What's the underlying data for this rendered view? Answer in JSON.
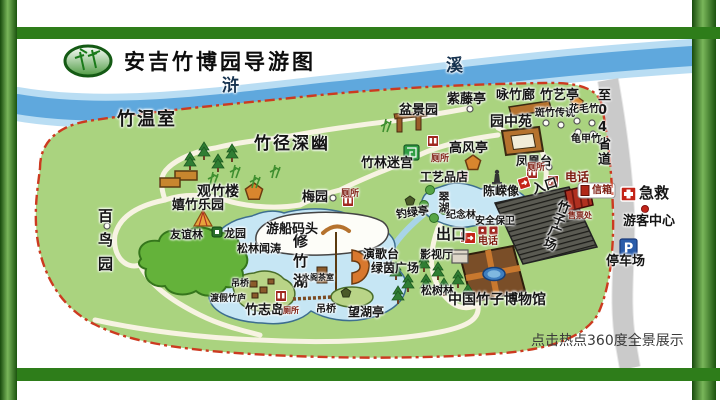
{
  "palette": {
    "frame_green": "#2e7d1a",
    "park_green": "#aad37f",
    "river_blue": "#5fa8dd",
    "lake_blue": "#c6e6f4",
    "boundary_red": "#cc3a20",
    "road_gray": "#d2d2d2",
    "facility_red": "#a02820",
    "parking_blue": "#2a5caa"
  },
  "header": {
    "title": "安吉竹博园导游图"
  },
  "map": {
    "river_label_1": "浒",
    "river_label_2": "溪",
    "road_label": "至04省道",
    "footer_note": "点击热点360度全景展示",
    "pois": {
      "zhuwenshi": "竹温室",
      "zhujing_shenyou": "竹径深幽",
      "guanzhulou": "观竹楼",
      "xizhu_leyuan": "嬉竹乐园",
      "bainiaoyuan": "百鸟园",
      "youyilin": "友谊林",
      "longyuan": "龙园",
      "meiyuan": "梅园",
      "penjingyuan": "盆景园",
      "zitengting": "紫藤亭",
      "yongzhulang": "咏竹廊",
      "zhuyiting": "竹艺亭",
      "yuanzhongyuan": "园中苑",
      "banzhu_chuanshuo": "斑竹传说",
      "huamaozhu": "花毛竹",
      "guijiazhu": "龟甲竹",
      "zhulin_migong": "竹林迷宫",
      "gaofengting": "高风亭",
      "fenghuangtai": "凤凰台",
      "gongyipin_dian": "工艺品店",
      "chenrong_xiang": "陈嵘像",
      "cuihu": "翠湖",
      "diaolvting": "钓绿亭",
      "jinianlin": "纪念林",
      "yingshiting": "影视厅",
      "songshulin": "松树林",
      "museum": "中国竹子博物馆",
      "zhuzi_guangchang": "竹子广场",
      "xiuzhuhu": "修竹湖",
      "youchuan_matou": "游船码头",
      "yangetai": "演歌台",
      "lvyin_guangchang": "绿茵广场",
      "wanghuting": "望湖亭",
      "diaoqiao": "吊桥",
      "dujia_zhulu": "渡假竹庐",
      "zhuzhidao": "竹志岛",
      "shuige_chashi": "水阁茶室",
      "songlin_wentao": "松林闻涛"
    },
    "facilities": {
      "cesuo": "厕所",
      "dianhua": "电话",
      "xinxiang": "信箱",
      "shoupiaochu": "售票处",
      "rukou": "入口",
      "chukou": "出口",
      "anquan_baowei": "安全保卫",
      "jijiu": "急救",
      "youke_zhongxin": "游客中心",
      "tingchechang": "停车场",
      "parking_symbol": "P"
    }
  }
}
